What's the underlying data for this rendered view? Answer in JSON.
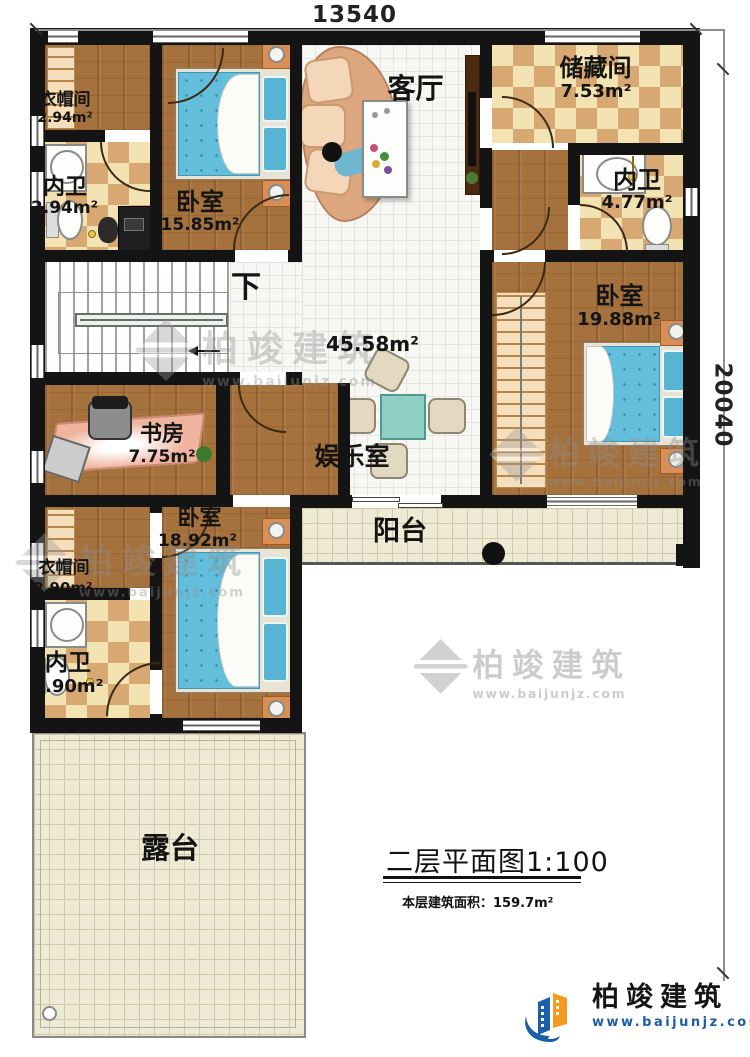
{
  "dimensions": {
    "top": "13540",
    "right": "20040"
  },
  "rooms": {
    "cloak_top": {
      "name": "衣帽间",
      "area": "2.94m²"
    },
    "bath_top": {
      "name": "内卫",
      "area": "2.94m²"
    },
    "bed_top": {
      "name": "卧室",
      "area": "15.85m²"
    },
    "living": {
      "name": "客厅"
    },
    "storage": {
      "name": "储藏间",
      "area": "7.53m²"
    },
    "bath_right": {
      "name": "内卫",
      "area": "4.77m²"
    },
    "bed_right": {
      "name": "卧室",
      "area": "19.88m²"
    },
    "hall": {
      "area": "45.58m²"
    },
    "stairs": {
      "name": "下"
    },
    "study": {
      "name": "书房",
      "area": "7.75m²"
    },
    "entertainment": {
      "name": "娱乐室"
    },
    "bed_bottom": {
      "name": "卧室",
      "area": "18.92m²"
    },
    "cloak_bottom": {
      "name": "衣帽间",
      "area": "2.90m²"
    },
    "bath_bottom": {
      "name": "内卫",
      "area": "2.90m²"
    },
    "balcony": {
      "name": "阳台"
    },
    "terrace": {
      "name": "露台"
    }
  },
  "title": {
    "main": "二层平面图1:100",
    "area_label": "本层建筑面积：",
    "area_value": "159.7m²"
  },
  "branding": {
    "company": "柏竣建筑",
    "website": "www.baijunjz.com"
  },
  "colors": {
    "brand_blue": "#1b5fa8",
    "brand_orange": "#f59a1e",
    "wall": "#141414",
    "bed": "#62bedb"
  }
}
